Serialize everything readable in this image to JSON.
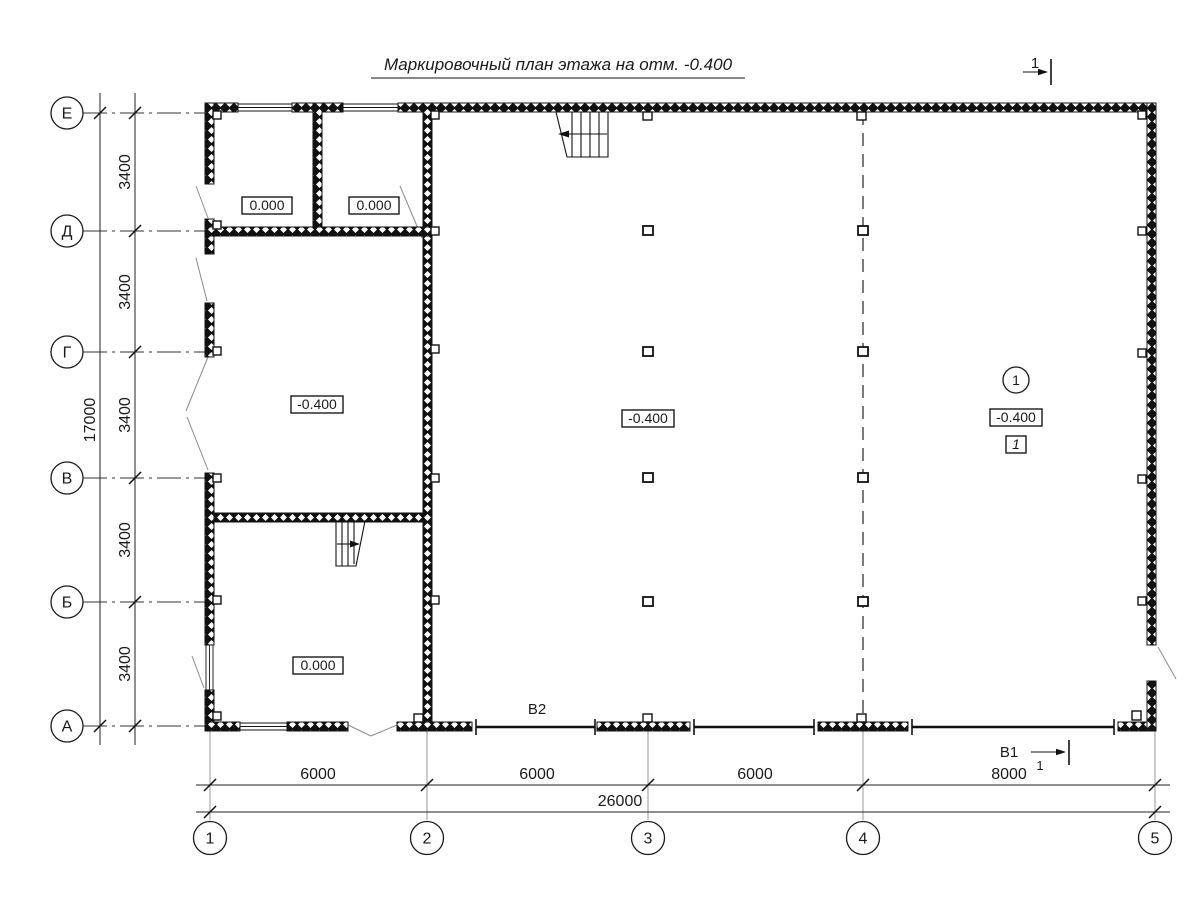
{
  "title": "Маркировочный план этажа на отм. -0.400",
  "axes": {
    "rows": [
      {
        "label": "Е"
      },
      {
        "label": "Д"
      },
      {
        "label": "Г"
      },
      {
        "label": "В"
      },
      {
        "label": "Б"
      },
      {
        "label": "А"
      }
    ],
    "cols": [
      {
        "label": "1"
      },
      {
        "label": "2"
      },
      {
        "label": "3"
      },
      {
        "label": "4"
      },
      {
        "label": "5"
      }
    ]
  },
  "dims": {
    "total_height": "17000",
    "row_segments": [
      "3400",
      "3400",
      "3400",
      "3400",
      "3400"
    ],
    "total_width": "26000",
    "col_segments": [
      "6000",
      "6000",
      "6000",
      "8000"
    ]
  },
  "marks": {
    "elev_room_top_1": "0.000",
    "elev_room_top_2": "0.000",
    "elev_room_mid_left": "-0.400",
    "elev_hall_center": "-0.400",
    "elev_hall_right": "-0.400",
    "elev_room_bottom": "0.000",
    "room_number": "1",
    "floor_type": "1",
    "beam_label": "В2",
    "view_label": "В1",
    "view_number": "1",
    "section_number": "1"
  },
  "colors": {
    "line": "#1a1a1a",
    "light_line": "#9a9a9a",
    "background": "#ffffff"
  }
}
